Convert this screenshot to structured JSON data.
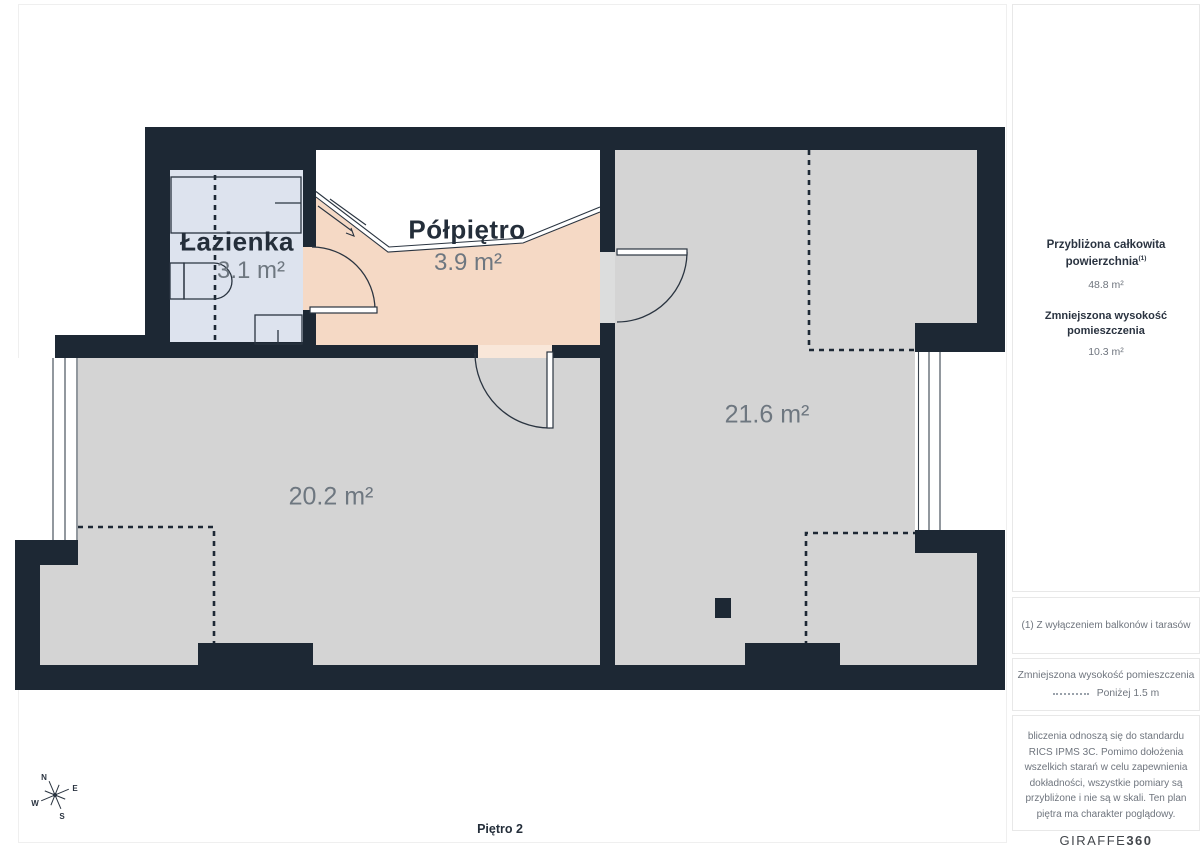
{
  "plan": {
    "rooms": [
      {
        "id": "lazienka",
        "name": "Łazienka",
        "area": "3.1 m²"
      },
      {
        "id": "polpietro",
        "name": "Półpiętro",
        "area": "3.9 m²"
      },
      {
        "id": "room-left",
        "name": "",
        "area": "20.2 m²"
      },
      {
        "id": "room-right",
        "name": "",
        "area": "21.6 m²"
      }
    ],
    "floor_label": "Piętro 2",
    "compass": {
      "n": "N",
      "e": "E",
      "s": "S",
      "w": "W"
    }
  },
  "sidebar": {
    "total_area": {
      "title_line1": "Przybliżona całkowita",
      "title_line2": "powierzchnia",
      "footnote_marker": "(1)",
      "value": "48.8 m²"
    },
    "reduced_height": {
      "title": "Zmniejszona wysokość pomieszczenia",
      "value": "10.3 m²"
    },
    "footnote": "(1) Z wyłączeniem balkonów i tarasów",
    "legend": {
      "title": "Zmniejszona wysokość pomieszczenia",
      "label": "Poniżej 1.5 m"
    },
    "disclaimer": "bliczenia odnoszą się do standardu RICS IPMS 3C. Pomimo dołożenia wszelkich starań w celu zapewnienia dokładności, wszystkie pomiary są przybliżone i nie są w skali. Ten plan piętra ma charakter poglądowy.",
    "brand": {
      "name": "GIRAFFE",
      "suffix": "360"
    }
  },
  "colors": {
    "wall": "#1d2834",
    "room": "#d4d4d4",
    "bathroom": "#dde3ee",
    "mezzanine": "#f5d9c5",
    "threshold": "#f9e7d9",
    "text_dark": "#242e3a",
    "text_grey": "#6f757e",
    "border_light": "#e8e8e8"
  }
}
